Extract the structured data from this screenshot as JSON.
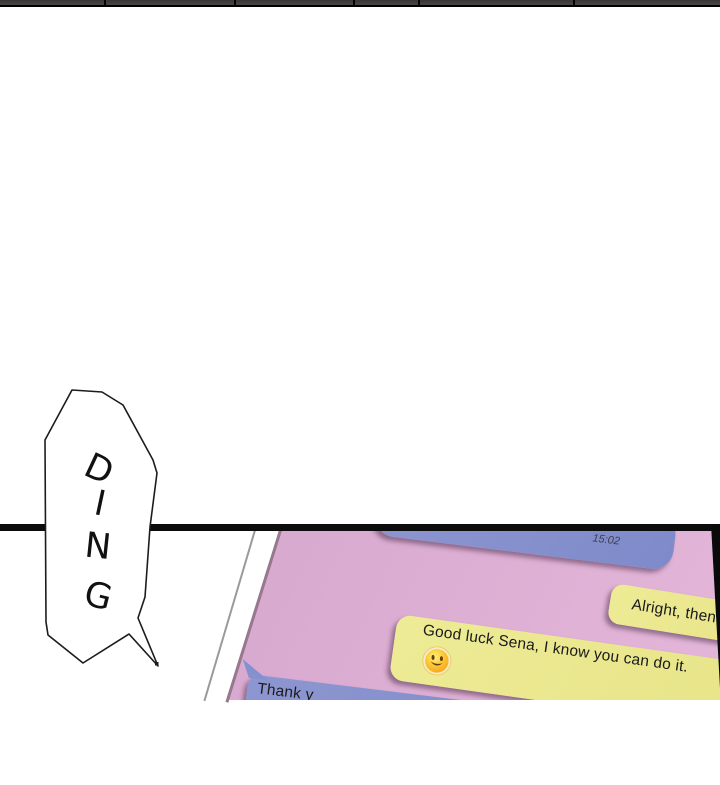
{
  "sfx_bubble": {
    "text": "DING",
    "letters": [
      "D",
      "I",
      "N",
      "G"
    ]
  },
  "phone_chat": {
    "received_bubble_top": {
      "timestamp": "15:02"
    },
    "sent_bubble_1": {
      "text": "Alright, then."
    },
    "sent_bubble_2": {
      "text": "Good luck Sena, I know you can do it.",
      "emoji": "smiley-face-emoji"
    },
    "received_bubble_bottom": {
      "text": "Thank y"
    },
    "colors": {
      "screen_pink": "#d8a9cf",
      "received_blue": "#8590ce",
      "sent_yellow": "#ebe88e",
      "emoji_yellow": "#fbc02d",
      "panel_bar_black": "#0c0c0c"
    }
  }
}
